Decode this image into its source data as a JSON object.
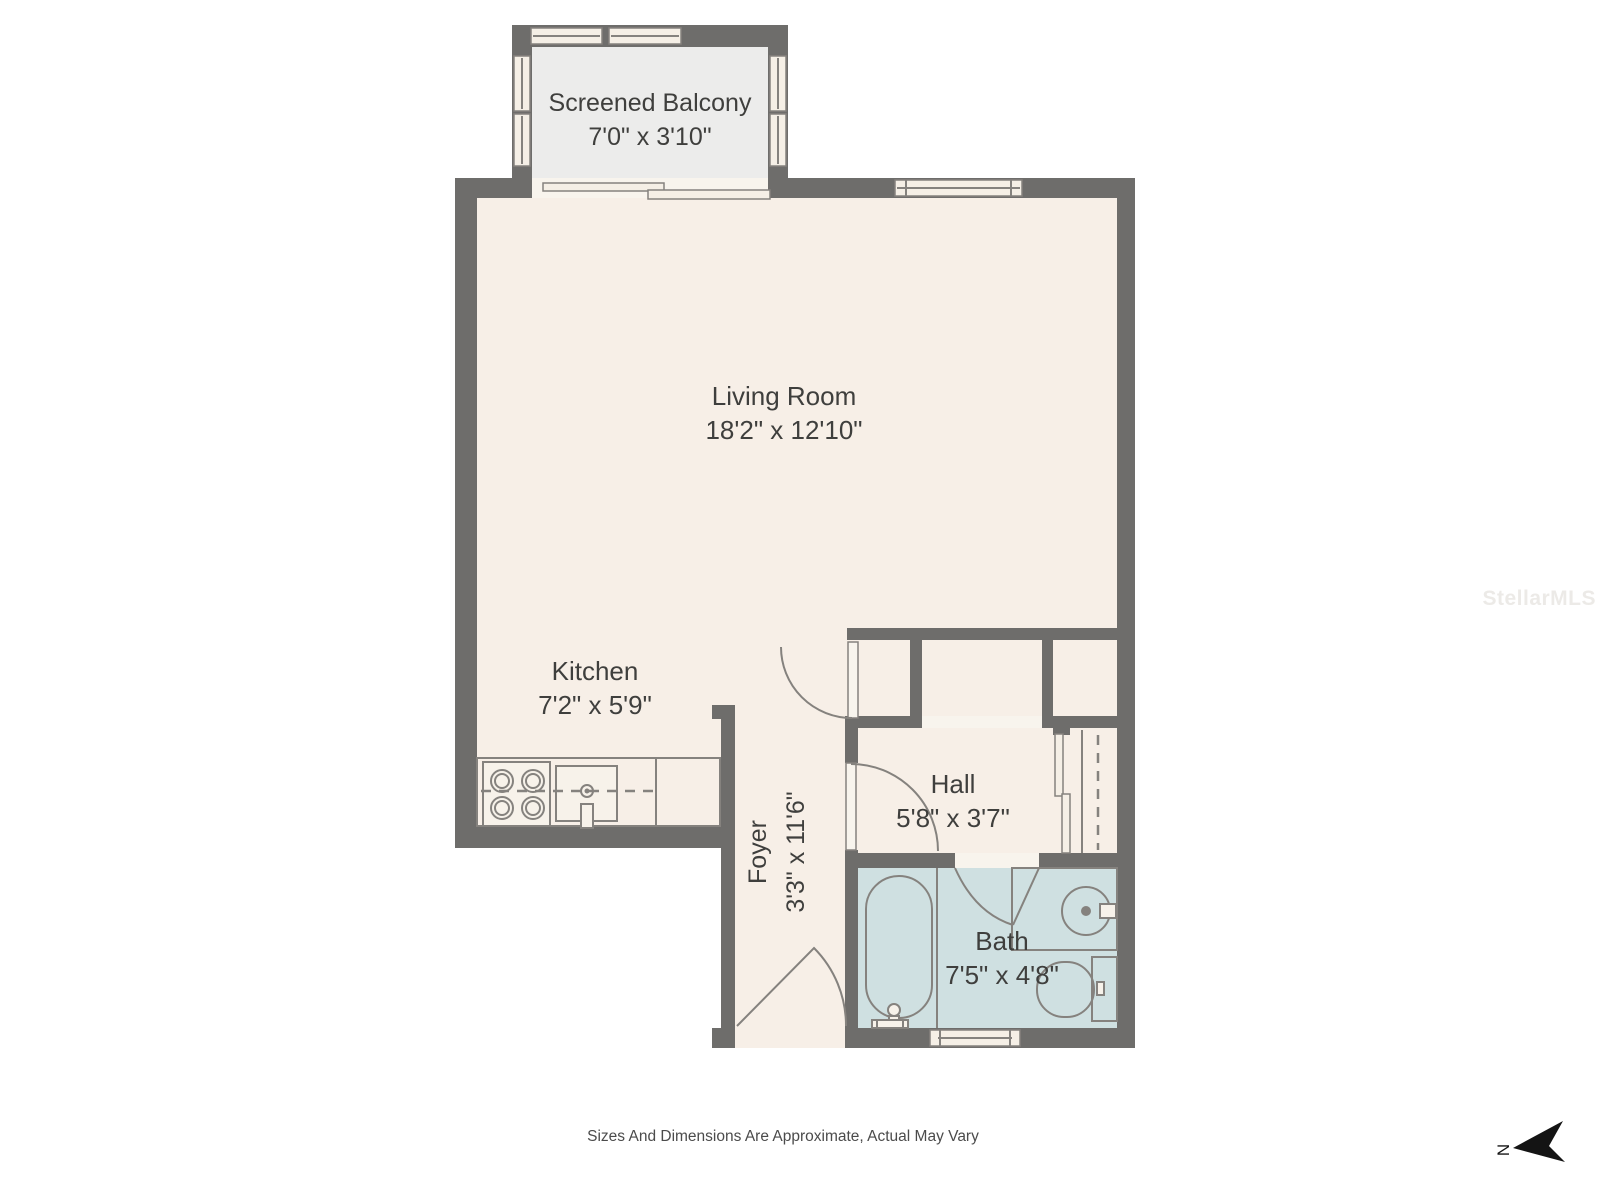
{
  "rooms": {
    "balcony": {
      "label": "Screened Balcony",
      "dims": "7'0\" x 3'10\""
    },
    "living": {
      "label": "Living Room",
      "dims": "18'2\" x 12'10\""
    },
    "kitchen": {
      "label": "Kitchen",
      "dims": "7'2\" x 5'9\""
    },
    "foyer": {
      "label": "Foyer",
      "dims": "3'3\" x 11'6\""
    },
    "hall": {
      "label": "Hall",
      "dims": "5'8\" x 3'7\""
    },
    "bath": {
      "label": "Bath",
      "dims": "7'5\" x 4'8\""
    }
  },
  "footer": {
    "caption": "Sizes And Dimensions Are Approximate, Actual May Vary"
  },
  "watermark": {
    "text": "StellarMLS"
  },
  "compass": {
    "letter": "N"
  },
  "colors": {
    "wall": "#6e6d6b",
    "floor": "#f7efe7",
    "balcony_floor": "#ececeb",
    "bath_floor": "#cfe0e1",
    "opening": "#f8f4ed",
    "window_fill": "#f5efe6",
    "line": "#85827e",
    "fixture_fill": "#f7f2ea",
    "text": "#3f3f3d",
    "caption": "#4b4b4b",
    "watermark": "#eceae7",
    "north": "#141414"
  }
}
